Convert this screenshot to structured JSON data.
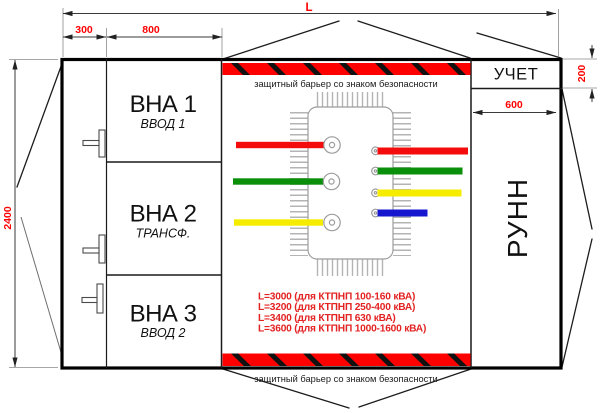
{
  "dimensions": {
    "overall_length": "L",
    "left_column_width": "300",
    "vna_width": "800",
    "height": "2400",
    "uchet_height": "200",
    "runn_width": "600"
  },
  "sections": {
    "vna1": {
      "title": "ВНА 1",
      "subtitle": "ВВОД 1"
    },
    "vna2": {
      "title": "ВНА 2",
      "subtitle": "ТРАНСФ."
    },
    "vna3": {
      "title": "ВНА 3",
      "subtitle": "ВВОД 2"
    },
    "uchet": {
      "title": "УЧЕТ"
    },
    "runn": {
      "title": "РУНН"
    }
  },
  "barrier": {
    "top_label": "защитный барьер со знаком безопасности",
    "bottom_label": "защитный барьер со знаком безопасности"
  },
  "length_table": [
    "L=3000 (для КТПНП 100-160 кВА)",
    "L=3200 (для КТПНП 250-400 кВА)",
    "L=3400 (для КТПНП 630 кВА)",
    "L=3600 (для КТПНП 1000-1600 кВА)"
  ],
  "colors": {
    "dim_red": "#ff0000",
    "list_red": "#e32222",
    "barrier_red": "#fe0000",
    "barrier_black": "#111111",
    "bar_red": "#f40b0b",
    "bar_green": "#0a8f0a",
    "bar_yellow": "#f6ec00",
    "bar_blue": "#1616cf"
  }
}
